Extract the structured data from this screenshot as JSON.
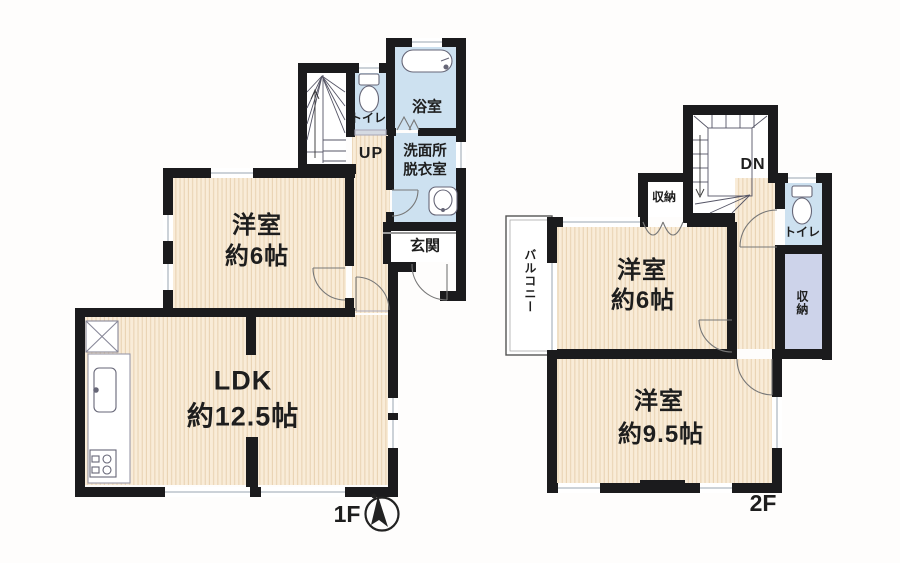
{
  "f1": {
    "floor_label": "1F",
    "stairs_dir": "UP",
    "yoshitsu": {
      "name": "洋室",
      "size": "約6帖"
    },
    "ldk": {
      "name": "LDK",
      "size": "約12.5帖"
    },
    "bath": "浴室",
    "washroom": {
      "line1": "洗面所",
      "line2": "脱衣室"
    },
    "toilet": "トイレ",
    "genkan": "玄関"
  },
  "f2": {
    "floor_label": "2F",
    "stairs_dir": "DN",
    "yoshitsu6": {
      "name": "洋室",
      "size": "約6帖"
    },
    "yoshitsu95": {
      "name": "洋室",
      "size": "約9.5帖"
    },
    "balcony": "バルコニー",
    "closet_left": "収納",
    "closet_right": "収納",
    "toilet": "トイレ"
  },
  "icons": {
    "bathtub": "bathtub-icon",
    "toilet_1f": "toilet-icon",
    "toilet_2f": "toilet-icon",
    "washbasin": "washbasin-icon",
    "kitchen_sink": "kitchen-sink-icon",
    "stove": "stove-icon",
    "refrigerator_space": "crossed-box-icon",
    "compass": "north-compass-icon"
  },
  "colors": {
    "wall": "#1b1b1d",
    "floor_cream": "#f9ecd8",
    "floor_stripe": "#e9d3b4",
    "wet_room_blue": "#cde1f0",
    "closet_lavender": "#cdd3ea",
    "background": "#fefdfc"
  }
}
